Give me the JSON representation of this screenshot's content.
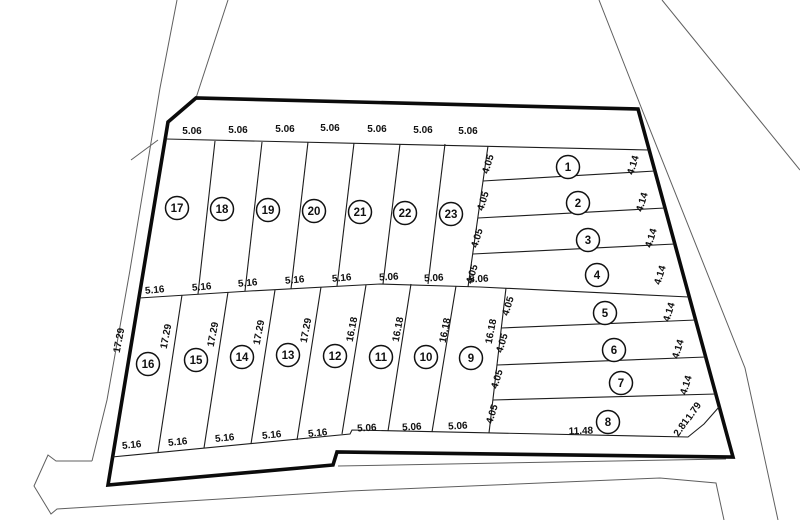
{
  "plan": {
    "kind": "cadastral subdivision plan",
    "lot_count": 23
  },
  "colors": {
    "boundary": "#0b0b0b",
    "lot_line": "#1d1d1d",
    "road": "#5f5f5f",
    "label": "#111111"
  },
  "lots": [
    {
      "n": "1",
      "x": 568,
      "y": 167
    },
    {
      "n": "2",
      "x": 578,
      "y": 203
    },
    {
      "n": "3",
      "x": 588,
      "y": 240
    },
    {
      "n": "4",
      "x": 597,
      "y": 275
    },
    {
      "n": "5",
      "x": 605,
      "y": 313
    },
    {
      "n": "6",
      "x": 614,
      "y": 350
    },
    {
      "n": "7",
      "x": 621,
      "y": 383
    },
    {
      "n": "8",
      "x": 608,
      "y": 422
    },
    {
      "n": "9",
      "x": 471,
      "y": 358
    },
    {
      "n": "10",
      "x": 426,
      "y": 357
    },
    {
      "n": "11",
      "x": 381,
      "y": 357
    },
    {
      "n": "12",
      "x": 335,
      "y": 356
    },
    {
      "n": "13",
      "x": 288,
      "y": 355
    },
    {
      "n": "14",
      "x": 242,
      "y": 357
    },
    {
      "n": "15",
      "x": 196,
      "y": 360
    },
    {
      "n": "16",
      "x": 148,
      "y": 364
    },
    {
      "n": "17",
      "x": 177,
      "y": 208
    },
    {
      "n": "18",
      "x": 222,
      "y": 209
    },
    {
      "n": "19",
      "x": 268,
      "y": 210
    },
    {
      "n": "20",
      "x": 314,
      "y": 211
    },
    {
      "n": "21",
      "x": 360,
      "y": 212
    },
    {
      "n": "22",
      "x": 405,
      "y": 213
    },
    {
      "n": "23",
      "x": 451,
      "y": 214
    }
  ],
  "dims": [
    {
      "t": "5.06",
      "x": 192,
      "y": 134,
      "r": 0
    },
    {
      "t": "5.06",
      "x": 238,
      "y": 133,
      "r": 0
    },
    {
      "t": "5.06",
      "x": 285,
      "y": 132,
      "r": 0
    },
    {
      "t": "5.06",
      "x": 330,
      "y": 131,
      "r": 0
    },
    {
      "t": "5.06",
      "x": 377,
      "y": 132,
      "r": 0
    },
    {
      "t": "5.06",
      "x": 423,
      "y": 133,
      "r": 0
    },
    {
      "t": "5.06",
      "x": 468,
      "y": 134,
      "r": 0
    },
    {
      "t": "5.16",
      "x": 155,
      "y": 293,
      "r": -5
    },
    {
      "t": "5.16",
      "x": 202,
      "y": 290,
      "r": -5
    },
    {
      "t": "5.16",
      "x": 248,
      "y": 286,
      "r": -5
    },
    {
      "t": "5.16",
      "x": 295,
      "y": 283,
      "r": -5
    },
    {
      "t": "5.16",
      "x": 342,
      "y": 281,
      "r": -5
    },
    {
      "t": "5.06",
      "x": 389,
      "y": 280,
      "r": -3
    },
    {
      "t": "5.06",
      "x": 434,
      "y": 281,
      "r": -3
    },
    {
      "t": "5.06",
      "x": 479,
      "y": 282,
      "r": -3
    },
    {
      "t": "5.16",
      "x": 132,
      "y": 448,
      "r": -6
    },
    {
      "t": "5.16",
      "x": 178,
      "y": 445,
      "r": -6
    },
    {
      "t": "5.16",
      "x": 225,
      "y": 441,
      "r": -6
    },
    {
      "t": "5.16",
      "x": 272,
      "y": 438,
      "r": -6
    },
    {
      "t": "5.16",
      "x": 318,
      "y": 436,
      "r": -6
    },
    {
      "t": "5.06",
      "x": 367,
      "y": 431,
      "r": -3
    },
    {
      "t": "5.06",
      "x": 412,
      "y": 430,
      "r": -3
    },
    {
      "t": "5.06",
      "x": 458,
      "y": 429,
      "r": -3
    },
    {
      "t": "11.48",
      "x": 581,
      "y": 434,
      "r": -2
    },
    {
      "t": "4.05",
      "x": 491,
      "y": 165,
      "r": -73
    },
    {
      "t": "4.05",
      "x": 486,
      "y": 202,
      "r": -73
    },
    {
      "t": "4.05",
      "x": 480,
      "y": 239,
      "r": -73
    },
    {
      "t": "4.05",
      "x": 475,
      "y": 275,
      "r": -73
    },
    {
      "t": "4.05",
      "x": 511,
      "y": 307,
      "r": -73
    },
    {
      "t": "4.05",
      "x": 505,
      "y": 344,
      "r": -73
    },
    {
      "t": "4.05",
      "x": 500,
      "y": 380,
      "r": -73
    },
    {
      "t": "4.05",
      "x": 495,
      "y": 415,
      "r": -73
    },
    {
      "t": "4.14",
      "x": 636,
      "y": 166,
      "r": -73
    },
    {
      "t": "4.14",
      "x": 645,
      "y": 203,
      "r": -73
    },
    {
      "t": "4.14",
      "x": 654,
      "y": 239,
      "r": -73
    },
    {
      "t": "4.14",
      "x": 663,
      "y": 276,
      "r": -73
    },
    {
      "t": "4.14",
      "x": 672,
      "y": 313,
      "r": -73
    },
    {
      "t": "4.14",
      "x": 681,
      "y": 350,
      "r": -73
    },
    {
      "t": "4.14",
      "x": 689,
      "y": 386,
      "r": -73
    },
    {
      "t": "17.29",
      "x": 122,
      "y": 341,
      "r": -79
    },
    {
      "t": "17.29",
      "x": 169,
      "y": 337,
      "r": -79
    },
    {
      "t": "17.29",
      "x": 216,
      "y": 335,
      "r": -79
    },
    {
      "t": "17.29",
      "x": 262,
      "y": 333,
      "r": -79
    },
    {
      "t": "17.29",
      "x": 309,
      "y": 331,
      "r": -79
    },
    {
      "t": "16.18",
      "x": 355,
      "y": 330,
      "r": -79
    },
    {
      "t": "16.18",
      "x": 401,
      "y": 330,
      "r": -79
    },
    {
      "t": "16.18",
      "x": 448,
      "y": 331,
      "r": -79
    },
    {
      "t": "16.18",
      "x": 494,
      "y": 332,
      "r": -79
    },
    {
      "t": "2.81",
      "x": 684,
      "y": 429,
      "r": -55
    },
    {
      "t": "1.79",
      "x": 696,
      "y": 413,
      "r": -55
    }
  ]
}
